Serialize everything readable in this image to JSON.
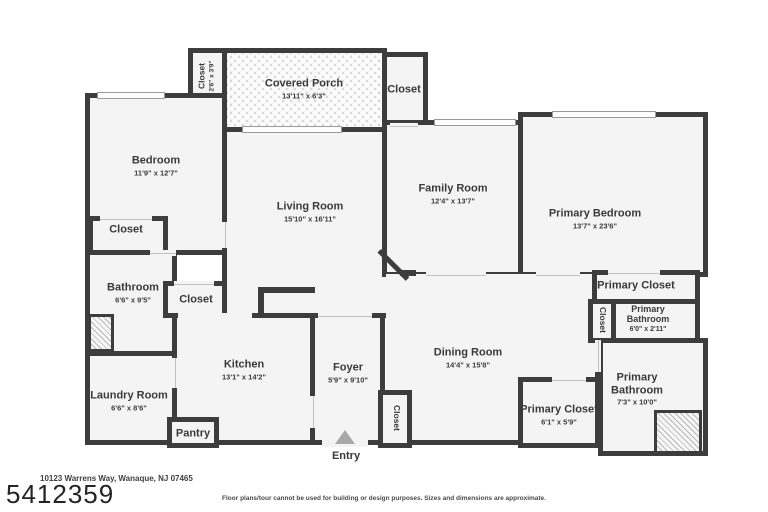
{
  "page": {
    "address": "10123 Warrens Way, Wanaque, NJ 07465",
    "listing_number": "5412359",
    "disclaimer": "Floor plans/tour cannot be used for building or design purposes. Sizes and dimensions are approximate.",
    "entry_label": "Entry"
  },
  "colors": {
    "wall": "#3d3d3d",
    "room_fill": "#f4f4f4",
    "entry_arrow": "#a8a8a8"
  },
  "rooms": {
    "closet_top_left": {
      "name": "Closet",
      "dims": "2'6\" x 3'9\""
    },
    "covered_porch": {
      "name": "Covered Porch",
      "dims": "13'11\" x 6'3\""
    },
    "closet_top_right": {
      "name": "Closet"
    },
    "bedroom": {
      "name": "Bedroom",
      "dims": "11'9\" x 12'7\""
    },
    "bedroom_closet": {
      "name": "Closet"
    },
    "bathroom": {
      "name": "Bathroom",
      "dims": "6'6\" x 9'5\""
    },
    "hall_closet": {
      "name": "Closet"
    },
    "laundry_room": {
      "name": "Laundry Room",
      "dims": "6'6\" x 8'6\""
    },
    "kitchen": {
      "name": "Kitchen",
      "dims": "13'1\" x 14'2\""
    },
    "pantry": {
      "name": "Pantry"
    },
    "living_room": {
      "name": "Living Room",
      "dims": "15'10\" x 16'11\""
    },
    "foyer": {
      "name": "Foyer",
      "dims": "5'9\" x 9'10\""
    },
    "foyer_closet": {
      "name": "Closet"
    },
    "dining_room": {
      "name": "Dining Room",
      "dims": "14'4\" x 15'8\""
    },
    "family_room": {
      "name": "Family Room",
      "dims": "12'4\" x 13'7\""
    },
    "primary_bedroom": {
      "name": "Primary Bedroom",
      "dims": "13'7\" x 23'6\""
    },
    "primary_closet_upper": {
      "name": "Primary Closet"
    },
    "primary_hall_closet": {
      "name": "Closet"
    },
    "primary_bathroom_small": {
      "name": "Primary Bathroom",
      "dims": "6'0\" x 2'11\""
    },
    "primary_bathroom_large": {
      "name": "Primary Bathroom",
      "dims": "7'3\" x 10'0\""
    },
    "primary_closet_lower": {
      "name": "Primary Closet",
      "dims": "6'1\" x 5'9\""
    }
  }
}
